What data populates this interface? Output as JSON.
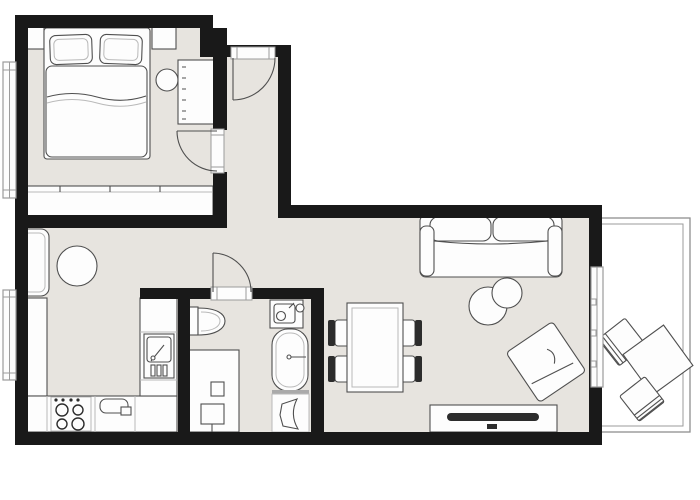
{
  "plan": {
    "kind": "apartment-floor-plan",
    "colors": {
      "wall": "#191919",
      "floor": "#e7e4df",
      "white": "#fdfdfd",
      "line": "#4f4f4f",
      "line_lite": "#b9b9b9",
      "dark": "#2c2c2c",
      "window": "#9b9b9b",
      "outside": "#ffffff"
    },
    "rooms": [
      {
        "name": "bedroom",
        "furniture": [
          "double-bed",
          "pillow",
          "pillow",
          "nightstand",
          "nightstand",
          "dresser",
          "round-stool",
          "wardrobe",
          "window",
          "door"
        ]
      },
      {
        "name": "hall-nook",
        "furniture": [
          "bench-seat",
          "round-table",
          "window"
        ]
      },
      {
        "name": "kitchen",
        "furniture": [
          "side-counter",
          "base-counter",
          "cooktop-4-burners",
          "sink",
          "tall-unit-appliance"
        ]
      },
      {
        "name": "bathroom",
        "furniture": [
          "toilet",
          "shower-washer-block",
          "washbasin",
          "bathtub",
          "hand-basin",
          "door"
        ]
      },
      {
        "name": "living-dining",
        "furniture": [
          "dining-table",
          "dining-chair",
          "dining-chair",
          "dining-chair",
          "dining-chair",
          "sofa",
          "coffee-table-round",
          "coffee-table-round",
          "armchair",
          "tv-console"
        ]
      },
      {
        "name": "balcony",
        "furniture": [
          "lounge-chair",
          "side-table",
          "lounge-chair",
          "balcony-door"
        ]
      },
      {
        "name": "entry",
        "furniture": [
          "front-door"
        ]
      }
    ]
  }
}
